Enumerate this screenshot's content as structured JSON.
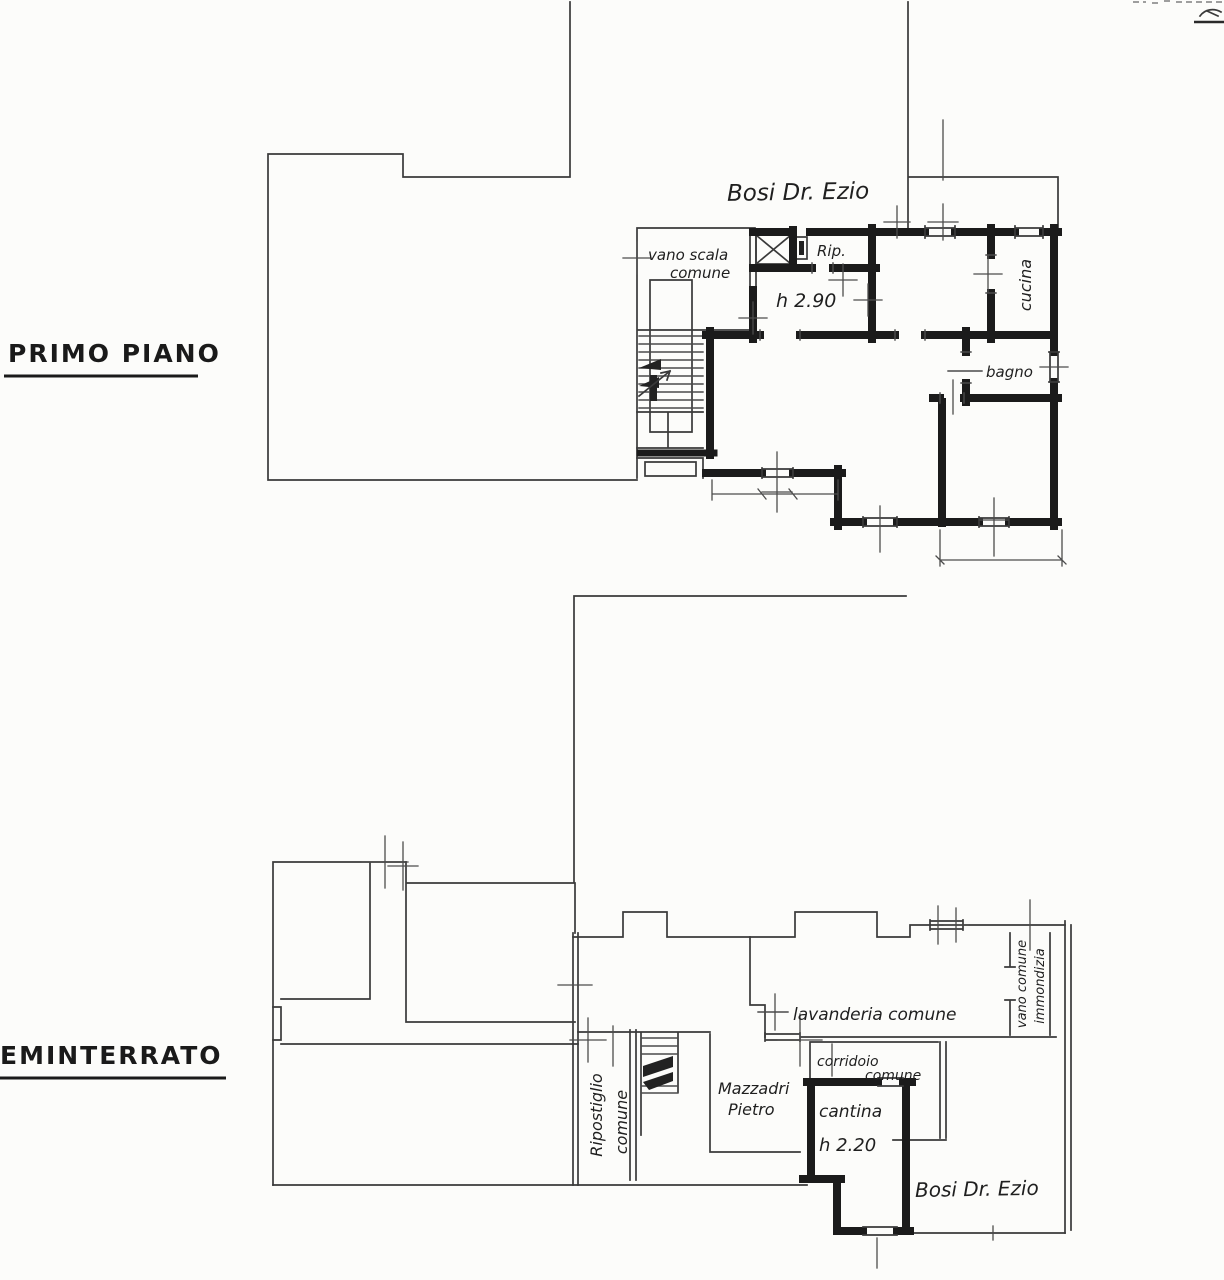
{
  "document": {
    "type": "scanned cadastral floor plan drawing",
    "paper_color": "#fcfcfa",
    "ink_color": "#2e2e2e",
    "wall_color": "#1b1b1b"
  },
  "primo_piano": {
    "floor_label": "PRIMO PIANO",
    "owner_label": "Bosi Dr. Ezio",
    "rooms": {
      "vano_scala_line1": "vano scala",
      "vano_scala_line2": "comune",
      "rip": "Rip.",
      "height_note": "h 2.90",
      "cucina": "cucina",
      "bagno": "bagno"
    }
  },
  "seminterrato": {
    "floor_label": "EMINTERRATO",
    "owner_label": "Bosi Dr. Ezio",
    "rooms": {
      "ripostiglio_line1": "Ripostiglio",
      "ripostiglio_line2": "comune",
      "lavanderia": "lavanderia comune",
      "immondizia_line1": "vano comune",
      "immondizia_line2": "immondizia",
      "corridoio_line1": "corridoio",
      "corridoio_line2": "comune",
      "tenant_line1": "Mazzadri",
      "tenant_line2": "Pietro",
      "cantina": "cantina",
      "height_note": "h 2.20"
    }
  }
}
